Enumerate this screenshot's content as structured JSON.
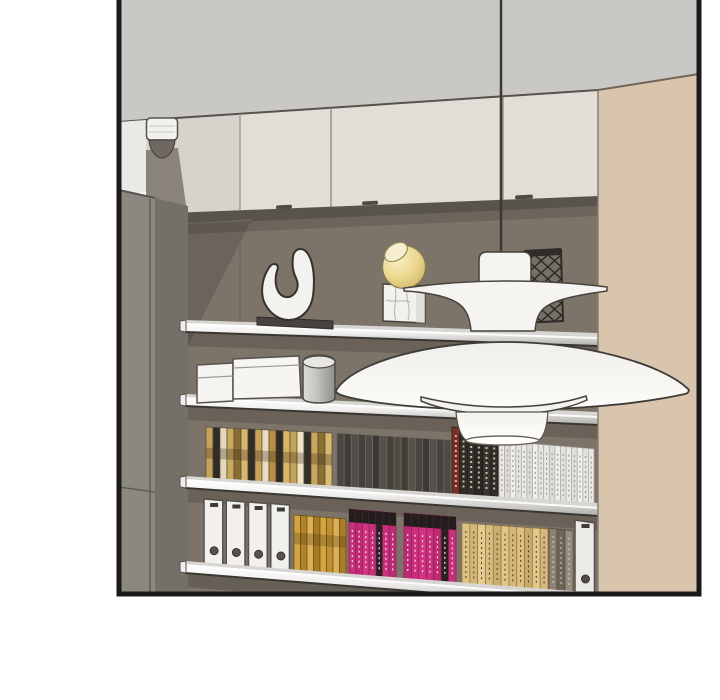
{
  "scene": {
    "type": "comic-panel-interior-illustration",
    "colors": {
      "page_bg": "#ffffff",
      "border": "#1a1a1a",
      "ceiling": "#c9c8c5",
      "cabinet": "#e0ded7",
      "cabinet_left": "#d6d3cc",
      "cabinet_side": "#ebe9e5",
      "soffit": "#59534d",
      "wall": "#7d7469",
      "wall_shadow": "#6c645c",
      "left_panel": "#8c8781",
      "left_panel_dark": "#757067",
      "right_panel": "#d9c4ae",
      "shelf_top": "#d7d6d3",
      "shelf_edge_dark": "#3a3733",
      "lamp_white": "#f5f4f1",
      "lamp_outline": "#45423d",
      "cord": "#3b3834",
      "sphere_yellow": "#ecd88f",
      "marble_white": "#f2f1ee",
      "sculpture_white": "#f3f2ef",
      "sculpture_base": "#46423d",
      "lattice_vase_dark": "#2e2b28",
      "box_white": "#f4f3f0",
      "handle_dark": "#4e4a44",
      "detector_white": "#f2f1ee",
      "detector_dome": "#6e6860"
    },
    "book_groups": [
      {
        "name": "shelf3-books-gold-mix",
        "x0": 206,
        "x1": 332,
        "top0": 427,
        "top1": 433,
        "bot0": 481,
        "bot1": 489,
        "colors": [
          "#c8a355",
          "#2f2c28",
          "#e4d8bb",
          "#caa85c",
          "#8a6f33",
          "#d8b76a",
          "#2f2c28",
          "#c8a355",
          "#e9ddc1",
          "#b98f3e",
          "#2f2c28",
          "#d6b566",
          "#c8a355",
          "#efe3c6",
          "#34302c",
          "#c9a657",
          "#8a6f33",
          "#d9b96c"
        ],
        "sep": "#55493a",
        "band": {
          "color": "#3a3020",
          "opacity": 0.3,
          "from": 0.38,
          "to": 0.58
        }
      },
      {
        "name": "shelf3-books-dark-gray",
        "x0": 337,
        "x1": 451,
        "top0": 433,
        "top1": 440,
        "bot0": 489,
        "bot1": 497,
        "colors": [
          "#4a4742",
          "#3f3c38",
          "#524e48",
          "#44403c",
          "#4d4944",
          "#3b3835",
          "#55514b",
          "#454139",
          "#4f4b45",
          "#403d39",
          "#575349",
          "#484440",
          "#3d3a36",
          "#534f49",
          "#464340",
          "#4e4a44"
        ],
        "sep": "#6e6a63"
      },
      {
        "name": "shelf3-books-black-red",
        "x0": 452,
        "x1": 498,
        "top0": 427,
        "top1": 430,
        "bot0": 497,
        "bot1": 500,
        "colors": [
          "#7e2d28",
          "#2f2c29",
          "#343030",
          "#2b2826",
          "#383432",
          "#302c2a"
        ],
        "sep": "#1e1c1a",
        "text": {
          "color": "#cdbb96",
          "w": 2
        }
      },
      {
        "name": "shelf3-books-white",
        "x0": 499,
        "x1": 594,
        "top0": 441,
        "top1": 449,
        "bot0": 500,
        "bot1": 507,
        "colors": [
          "#e9e8e5",
          "#dedcd8",
          "#efeeeb",
          "#e3e2de",
          "#eae9e6",
          "#dddbd7",
          "#f0efec",
          "#e5e4e0",
          "#e9e8e5",
          "#dedcd8",
          "#eeede9",
          "#e2e1dd",
          "#ebeae7",
          "#dfdeda",
          "#f0efec",
          "#e4e3df",
          "#e8e7e4"
        ],
        "sep": "#aaa9a5",
        "text": {
          "color": "#8f8e8a",
          "w": 1
        }
      },
      {
        "name": "shelf4-white-binders",
        "type": "binders",
        "x0": 203,
        "x1": 292,
        "count": 4,
        "top0": 499,
        "top1": 505,
        "bot0": 565,
        "bot1": 572,
        "color": "#f1f0ed",
        "hole": "#56524c"
      },
      {
        "name": "shelf4-books-gold",
        "x0": 294,
        "x1": 346,
        "top0": 515,
        "top1": 519,
        "bot0": 573,
        "bot1": 577,
        "colors": [
          "#d3a440",
          "#b3832c",
          "#dcb155",
          "#a97b26",
          "#d3a440",
          "#c1912f",
          "#dcb155",
          "#ab7d28"
        ],
        "sep": "#6b4f14",
        "band": {
          "color": "#3c2c06",
          "opacity": 0.25,
          "from": 0.3,
          "to": 0.5
        }
      },
      {
        "name": "shelf4-books-magenta-left",
        "x0": 349,
        "x1": 396,
        "top0": 509,
        "top1": 513,
        "bot0": 577,
        "bot1": 581,
        "colors": [
          "#cb2e7a",
          "#c02a72",
          "#d23482",
          "#cb2e7a",
          "#262320",
          "#cb2e7a",
          "#c02a72"
        ],
        "sep": "#8e1f55",
        "cap": {
          "color": "#211e1c",
          "h": 13
        },
        "text": {
          "color": "#f2e6ee",
          "w": 1.2
        }
      },
      {
        "name": "shelf4-books-magenta-right",
        "x0": 404,
        "x1": 456,
        "top0": 513,
        "top1": 517,
        "bot0": 581,
        "bot1": 585,
        "colors": [
          "#c02a72",
          "#cb2e7a",
          "#d23482",
          "#cb2e7a",
          "#c02a72",
          "#262320",
          "#cb2e7a"
        ],
        "sep": "#8e1f55",
        "cap": {
          "color": "#211e1c",
          "h": 13
        },
        "text": {
          "color": "#f2e6ee",
          "w": 1.2
        }
      },
      {
        "name": "shelf4-books-tan",
        "x0": 462,
        "x1": 548,
        "top0": 523,
        "top1": 529,
        "bot0": 586,
        "bot1": 592,
        "colors": [
          "#dec284",
          "#d4b677",
          "#e3ca90",
          "#d9bd7e",
          "#cdb06f",
          "#e0c689",
          "#d4b677",
          "#debf82",
          "#c9ab69",
          "#e2c88e",
          "#d6b97a"
        ],
        "sep": "#8a7440",
        "text": {
          "color": "#4a3c1e",
          "w": 1
        }
      },
      {
        "name": "shelf4-books-taupe",
        "x0": 549,
        "x1": 573,
        "top0": 528,
        "top1": 531,
        "bot0": 592,
        "bot1": 594,
        "colors": [
          "#8d8172",
          "#6e6457",
          "#978b7b"
        ],
        "sep": "#4f4a40",
        "text": {
          "color": "#d8d0c2",
          "w": 1
        }
      },
      {
        "name": "shelf4-white-binder-right",
        "type": "binders",
        "x0": 574,
        "x1": 597,
        "count": 1,
        "top0": 520,
        "top1": 523,
        "bot0": 592,
        "bot1": 595,
        "color": "#eceae6",
        "hole": "#4f4b46"
      }
    ]
  }
}
